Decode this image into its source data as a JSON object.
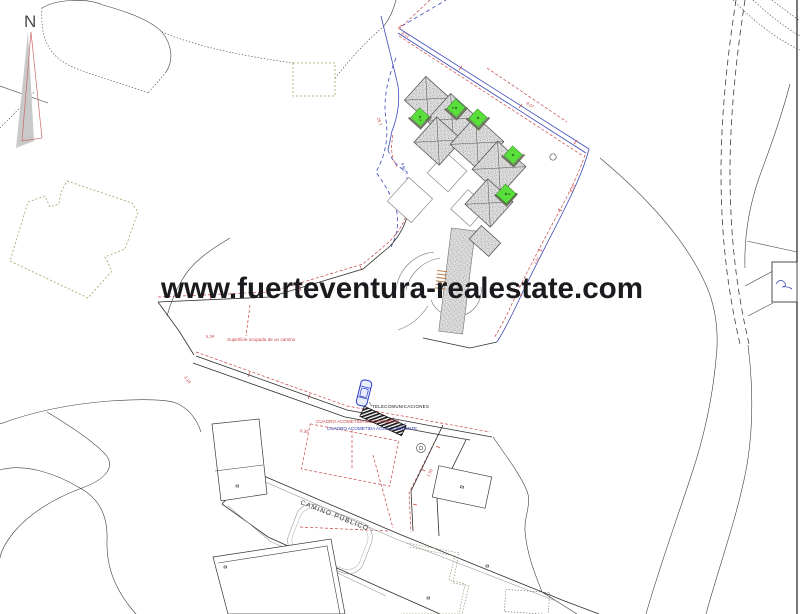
{
  "canvas": {
    "width": 800,
    "height": 614,
    "background": "#ffffff"
  },
  "watermark": {
    "text": "www.fuerteventura-realestate.com",
    "color": "#1b1b1f"
  },
  "compass": {
    "label": "N"
  },
  "plan_labels": {
    "occupied_path": "Superficie ocupada de un camino",
    "telecom": "TELECOMUNICACIONES",
    "electric_box": "CUADRO ACOMETIDA ELECTRICIDAD",
    "water_box": "CUADRO ACOMETIDA AGUA CORRIENTE",
    "public_road": "CAMINO PÚBLICO"
  },
  "dimensions": [
    "8.12",
    "25.7",
    "5.34",
    "3.18",
    "9.15",
    "7.07",
    "1.50",
    "6.35",
    "8.07",
    "4.96"
  ],
  "colors": {
    "boundary_blue": "#3a49b8",
    "setback_red": "#c84444",
    "pool_green": "#5ade3c",
    "roof_gray": "#d9d9d9",
    "tan_outline": "#a9a065",
    "car_blue": "#2c3dbe",
    "contour": "#3f3f3f"
  }
}
